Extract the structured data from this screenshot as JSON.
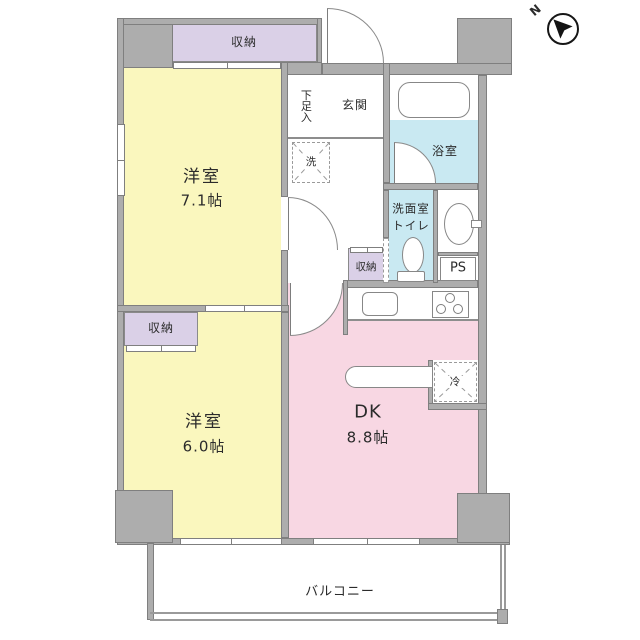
{
  "compass": {
    "north_label": "N"
  },
  "rooms": {
    "storage_top": "収納",
    "storage_mid": "収納",
    "storage_hall": "収納",
    "western1": {
      "name": "洋室",
      "size": "7.1帖"
    },
    "western2": {
      "name": "洋室",
      "size": "6.0帖"
    },
    "dk": {
      "name": "DK",
      "size": "8.8帖"
    },
    "entrance": "玄関",
    "shoe_cabinet": "下足入",
    "bathroom": "浴室",
    "washroom_line1": "洗面室",
    "washroom_line2": "トイレ",
    "pipe_space": "PS",
    "balcony": "バルコニー"
  },
  "fixtures": {
    "washer": "洗",
    "fridge": "冷"
  },
  "colors": {
    "wall": "#ADADAD",
    "western_room": "#FAF7BE",
    "dining_kitchen": "#F8D7E3",
    "storage": "#DAD0E7",
    "bath": "#C9E9F2"
  }
}
